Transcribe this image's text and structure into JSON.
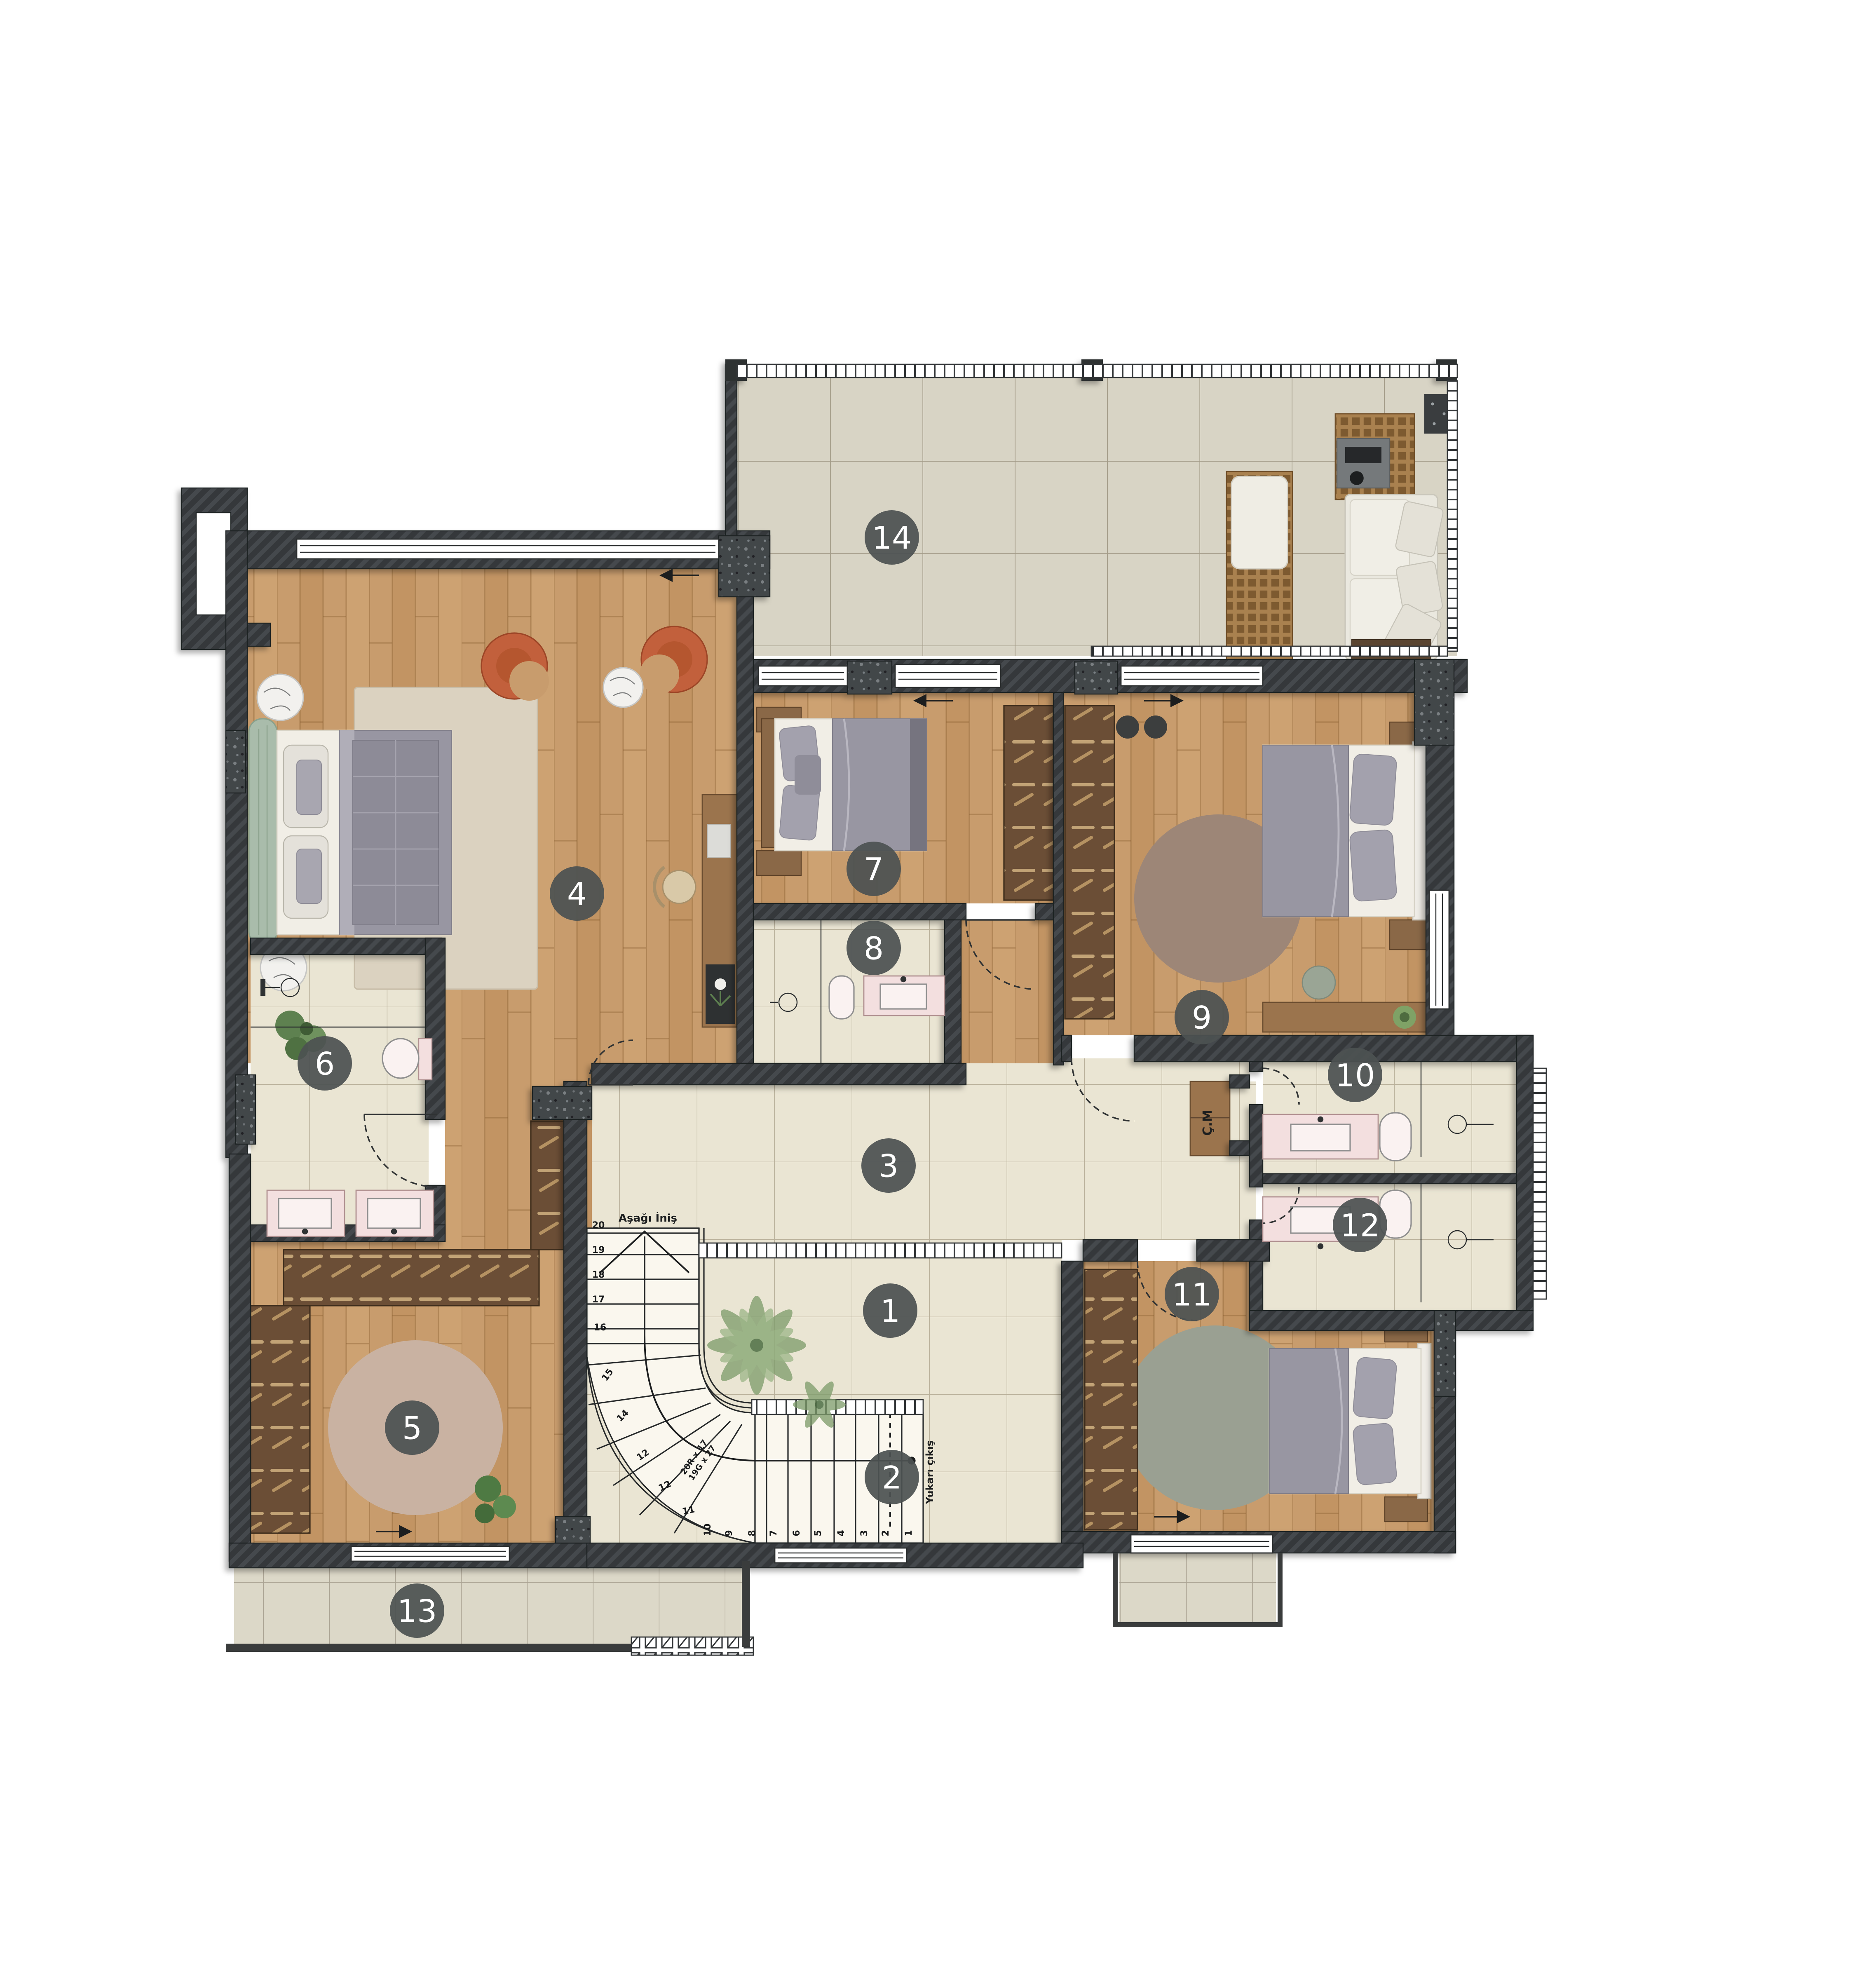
{
  "plan_title": "Upper floor plan",
  "rooms": [
    {
      "number": "1"
    },
    {
      "number": "2"
    },
    {
      "number": "3"
    },
    {
      "number": "4"
    },
    {
      "number": "5"
    },
    {
      "number": "6"
    },
    {
      "number": "7"
    },
    {
      "number": "8"
    },
    {
      "number": "9"
    },
    {
      "number": "10"
    },
    {
      "number": "11"
    },
    {
      "number": "12"
    },
    {
      "number": "13"
    },
    {
      "number": "14"
    }
  ],
  "stairs": {
    "down_label": "Aşağı İniş",
    "up_label": "Yukarı çıkış",
    "dimension_label_1": "20R x 17",
    "dimension_label_2": "19G x 27",
    "step_numbers": [
      "1",
      "2",
      "3",
      "4",
      "5",
      "6",
      "7",
      "8",
      "9",
      "10",
      "11",
      "12",
      "13",
      "14",
      "15",
      "16",
      "17",
      "18",
      "19",
      "20"
    ]
  },
  "closet_label": "Ç.M",
  "colors": {
    "wall": "#35383a",
    "concrete": "#43474a",
    "wood_floor": "#c89c6d",
    "tile_cream": "#eae5d3",
    "tile_terrace": "#d8d4c5",
    "label_circle": "#4c5252",
    "fixture_pink": "#f3dfdf",
    "armchair_orange": "#c2603c",
    "headboard_green": "#a9bcab",
    "rug_master": "#dbd2c0",
    "rug_room9": "#9d8677",
    "rug_room11": "#9aa092",
    "rug_room5": "#c9b2a2"
  }
}
